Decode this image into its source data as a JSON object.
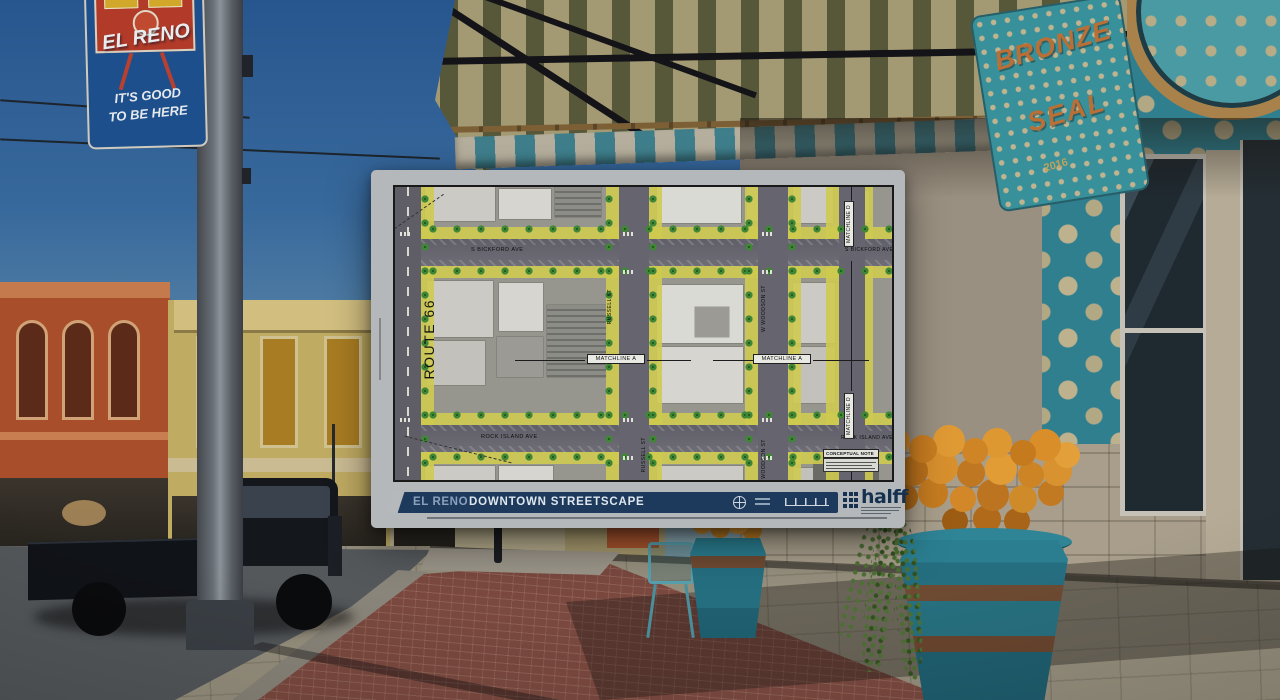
{
  "scene": {
    "pole_banner": {
      "title": "EL RENO",
      "tagline_line1": "IT'S GOOD",
      "tagline_line2": "TO BE HERE"
    },
    "window_sign": {
      "word1": "BRONZE",
      "word2": "SEAL",
      "year": "2016"
    }
  },
  "plan_sheet": {
    "title_block": {
      "city": "EL RENO",
      "project": "DOWNTOWN STREETSCAPE",
      "firm_logo_text": "halff"
    },
    "map_labels": {
      "route_66": "ROUTE 66",
      "s_bickford_ave": "S BICKFORD AVE",
      "rock_island_ave": "ROCK ISLAND AVE",
      "russell_st": "RUSSELL ST",
      "w_woodson_st": "W WOODSON ST",
      "woodson_st": "WOODSON ST",
      "matchline_a": "MATCHLINE A",
      "matchline_d": "MATCHLINE D",
      "conceptual_note": "CONCEPTUAL NOTE"
    },
    "colors": {
      "sidewalk_highlight_yellow": "#cec850",
      "title_bar_navy": "#1d3a5c",
      "halff_navy": "#16304f",
      "tree_green": "#3f8636",
      "mural_teal": "#2f7f8f"
    },
    "icons": {
      "north_arrow": "north-arrow-icon",
      "scale": "scale-bar",
      "firm_logo": "halff-grid-logo"
    }
  }
}
